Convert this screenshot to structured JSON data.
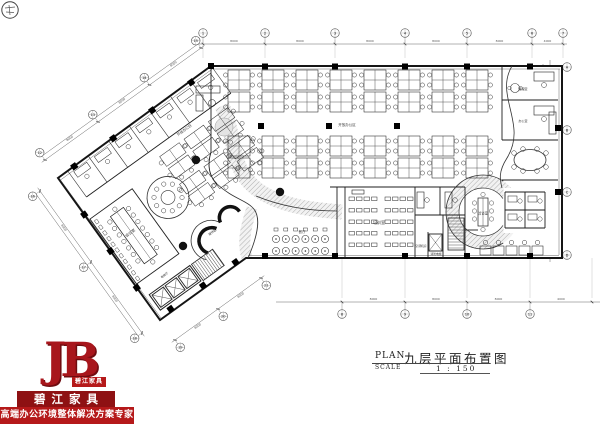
{
  "page": {
    "type": "architectural-floor-plan",
    "background": "#ffffff"
  },
  "title_block": {
    "plan_label": "PLAN",
    "scale_label": "SCALE",
    "drawing_title": "九层平面布置图",
    "scale_value": "1 : 150"
  },
  "logo": {
    "monogram": "JB",
    "badge": "碧江家具",
    "company_name": "碧江家具",
    "tagline": "高端办公环境整体解决方案专家",
    "colors": {
      "banner_dark": "#8e1113",
      "banner_bright": "#b5191a",
      "monogram_red": "#a8161c"
    }
  },
  "grid_bubbles": {
    "top": [
      "1",
      "2",
      "3",
      "4",
      "5",
      "6",
      "7"
    ],
    "right": [
      "A",
      "B",
      "C",
      "D"
    ],
    "bottom": [
      "8",
      "9",
      "10",
      "11"
    ],
    "wing_top": [
      "12",
      "13",
      "14",
      "15"
    ],
    "wing_left": [
      "16",
      "17",
      "18"
    ],
    "wing_bottom": [
      "19",
      "20",
      "21"
    ]
  },
  "dimensions": {
    "top": [
      "8000",
      "8000",
      "8000",
      "8000",
      "8000",
      "4000"
    ],
    "right": [
      "8000",
      "8000",
      "8000"
    ],
    "bottom": [
      "8000",
      "8000",
      "8000",
      "4000"
    ],
    "wing_top": [
      "8000",
      "8000",
      "8000"
    ],
    "wing_left": [
      "8000",
      "8000"
    ],
    "wing_bottom": [
      "8000",
      "8000"
    ]
  },
  "room_labels": [
    {
      "text": "培训室"
    },
    {
      "text": "空调机房"
    },
    {
      "text": "消防电梯"
    },
    {
      "text": "洽谈室"
    },
    {
      "text": "会议室"
    },
    {
      "text": "经理室"
    },
    {
      "text": "办公室"
    },
    {
      "text": "接待区"
    },
    {
      "text": "餐厅"
    },
    {
      "text": "开放办公区"
    },
    {
      "text": "开放办公区"
    },
    {
      "text": "电梯厅"
    }
  ]
}
